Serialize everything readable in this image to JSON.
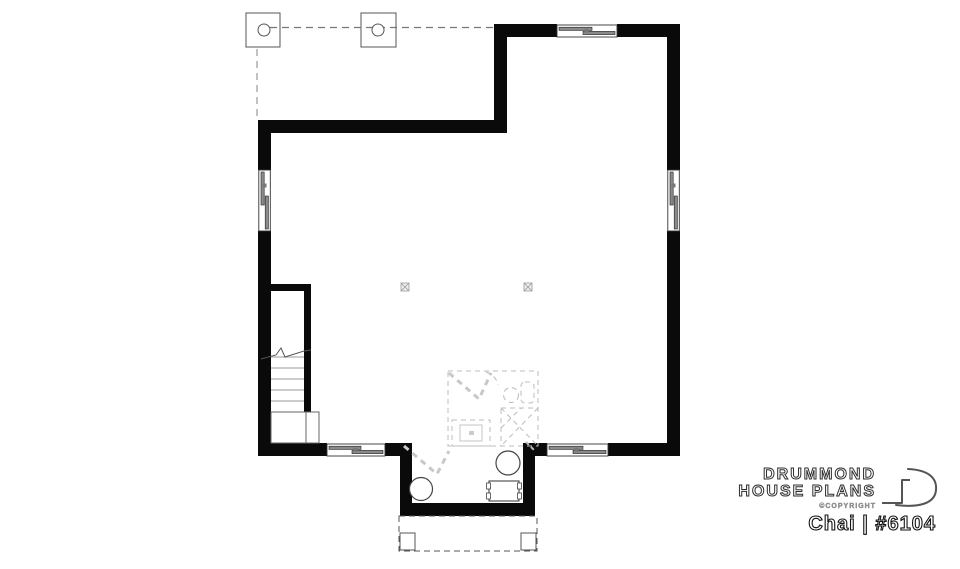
{
  "branding": {
    "logo_line1": "DRUMMOND",
    "logo_line2": "HOUSE PLANS",
    "copyright_label": "©COPYRIGHT",
    "plan_name": "Chai",
    "plan_number": "#6104",
    "plan_label": "Chai | #6104"
  },
  "colors": {
    "background": "#ffffff",
    "wall_black": "#0a0a0a",
    "thin_line": "#555555",
    "light_dashed": "#bcbcbc",
    "window_sash": "#8a8a8a",
    "logo_outline": "#2e2e2e",
    "copyright_gray": "#8d8d8d"
  }
}
